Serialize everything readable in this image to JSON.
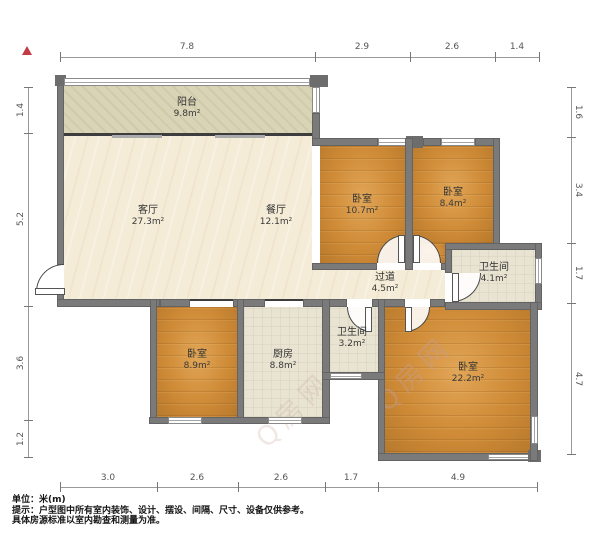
{
  "rooms": {
    "balcony": {
      "name": "阳台",
      "area": "9.8m²"
    },
    "living": {
      "name": "客厅",
      "area": "27.3m²"
    },
    "dining": {
      "name": "餐厅",
      "area": "12.1m²"
    },
    "bedroom_top_mid": {
      "name": "卧室",
      "area": "10.7m²"
    },
    "bedroom_top_right": {
      "name": "卧室",
      "area": "8.4m²"
    },
    "corridor": {
      "name": "过道",
      "area": "4.5m²"
    },
    "bathroom_right": {
      "name": "卫生间",
      "area": "4.1m²"
    },
    "bedroom_bottom_left": {
      "name": "卧室",
      "area": "8.9m²"
    },
    "kitchen": {
      "name": "厨房",
      "area": "8.8m²"
    },
    "bathroom_mid": {
      "name": "卫生间",
      "area": "3.2m²"
    },
    "bedroom_master": {
      "name": "卧室",
      "area": "22.2m²"
    }
  },
  "dimensions": {
    "top": [
      "7.8",
      "2.9",
      "2.6",
      "1.4"
    ],
    "left": [
      "1.4",
      "5.2",
      "3.6",
      "1.2"
    ],
    "right": [
      "1.6",
      "3.4",
      "1.7",
      "4.7"
    ],
    "bottom": [
      "3.0",
      "2.6",
      "2.6",
      "1.7",
      "4.9"
    ]
  },
  "watermark": "Q房网",
  "footer": {
    "unit": "单位：米(m)",
    "note1": "提示：户型图中所有室内装饰、设计、摆设、间隔、尺寸、设备仅供参考。",
    "note2": "具体房源标准以室内勘查和测量为准。"
  },
  "colors": {
    "wall": "#7a7a7a",
    "wood": "#cf8b37",
    "cream": "#f5ecd8",
    "tile": "#e9e3d2",
    "balcony": "#d9d4b6",
    "north_arrow": "#c43b45"
  }
}
